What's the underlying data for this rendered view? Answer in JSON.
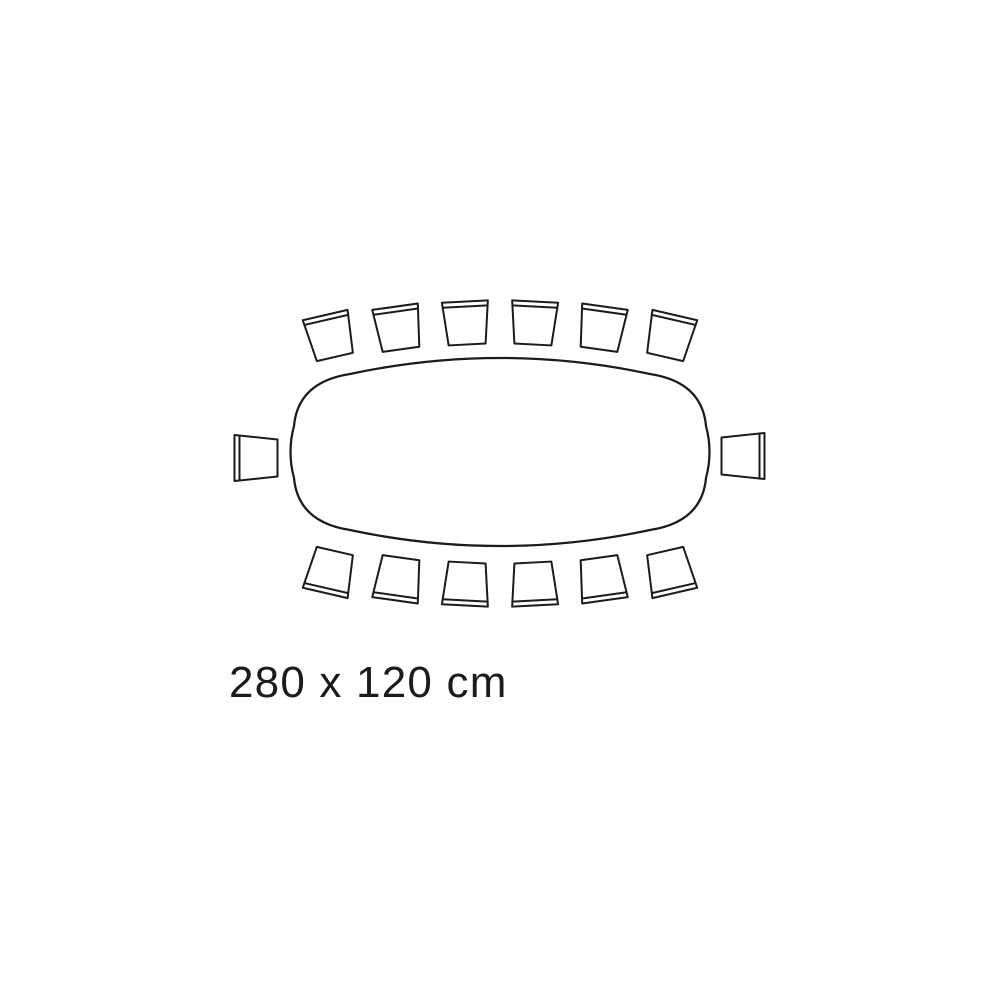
{
  "diagram": {
    "dimensions_label": "280 x 120 cm",
    "table_shape": "rounded rectangle",
    "table_width_cm": 280,
    "table_depth_cm": 120,
    "seats": {
      "top": 6,
      "bottom": 6,
      "left_end": 1,
      "right_end": 1,
      "total": 14
    }
  },
  "colors": {
    "line": "#1b1b1b",
    "background": "#ffffff"
  }
}
